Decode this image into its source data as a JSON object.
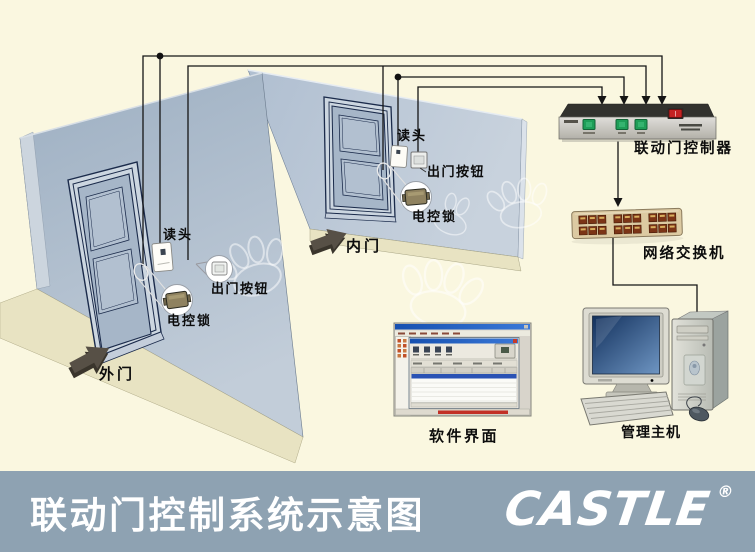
{
  "banner": {
    "title": "联动门控制系统示意图",
    "logo_text": "CASTLE",
    "registered": "®",
    "bg_color": "#8ea2b2"
  },
  "labels": {
    "outer_door": "外门",
    "inner_door": "内门",
    "outer_reader": "读头",
    "inner_reader": "读头",
    "outer_exit_button": "出门按钮",
    "inner_exit_button": "出门按钮",
    "outer_lock": "电控锁",
    "inner_lock": "电控锁",
    "controller": "联动门控制器",
    "network_switch": "网络交换机",
    "host": "管理主机",
    "software": "软件界面"
  },
  "colors": {
    "background": "#faf7e0",
    "wall": "#b3c1d2",
    "banner": "#8ea2b2",
    "wire": "#151515",
    "controller_button_green": "#1f9e58",
    "controller_switch_red": "#c42222",
    "switch_body_tan": "#dccaa2",
    "switch_port_maroon": "#7b3416",
    "skirting_beige": "#e8e3c2"
  }
}
